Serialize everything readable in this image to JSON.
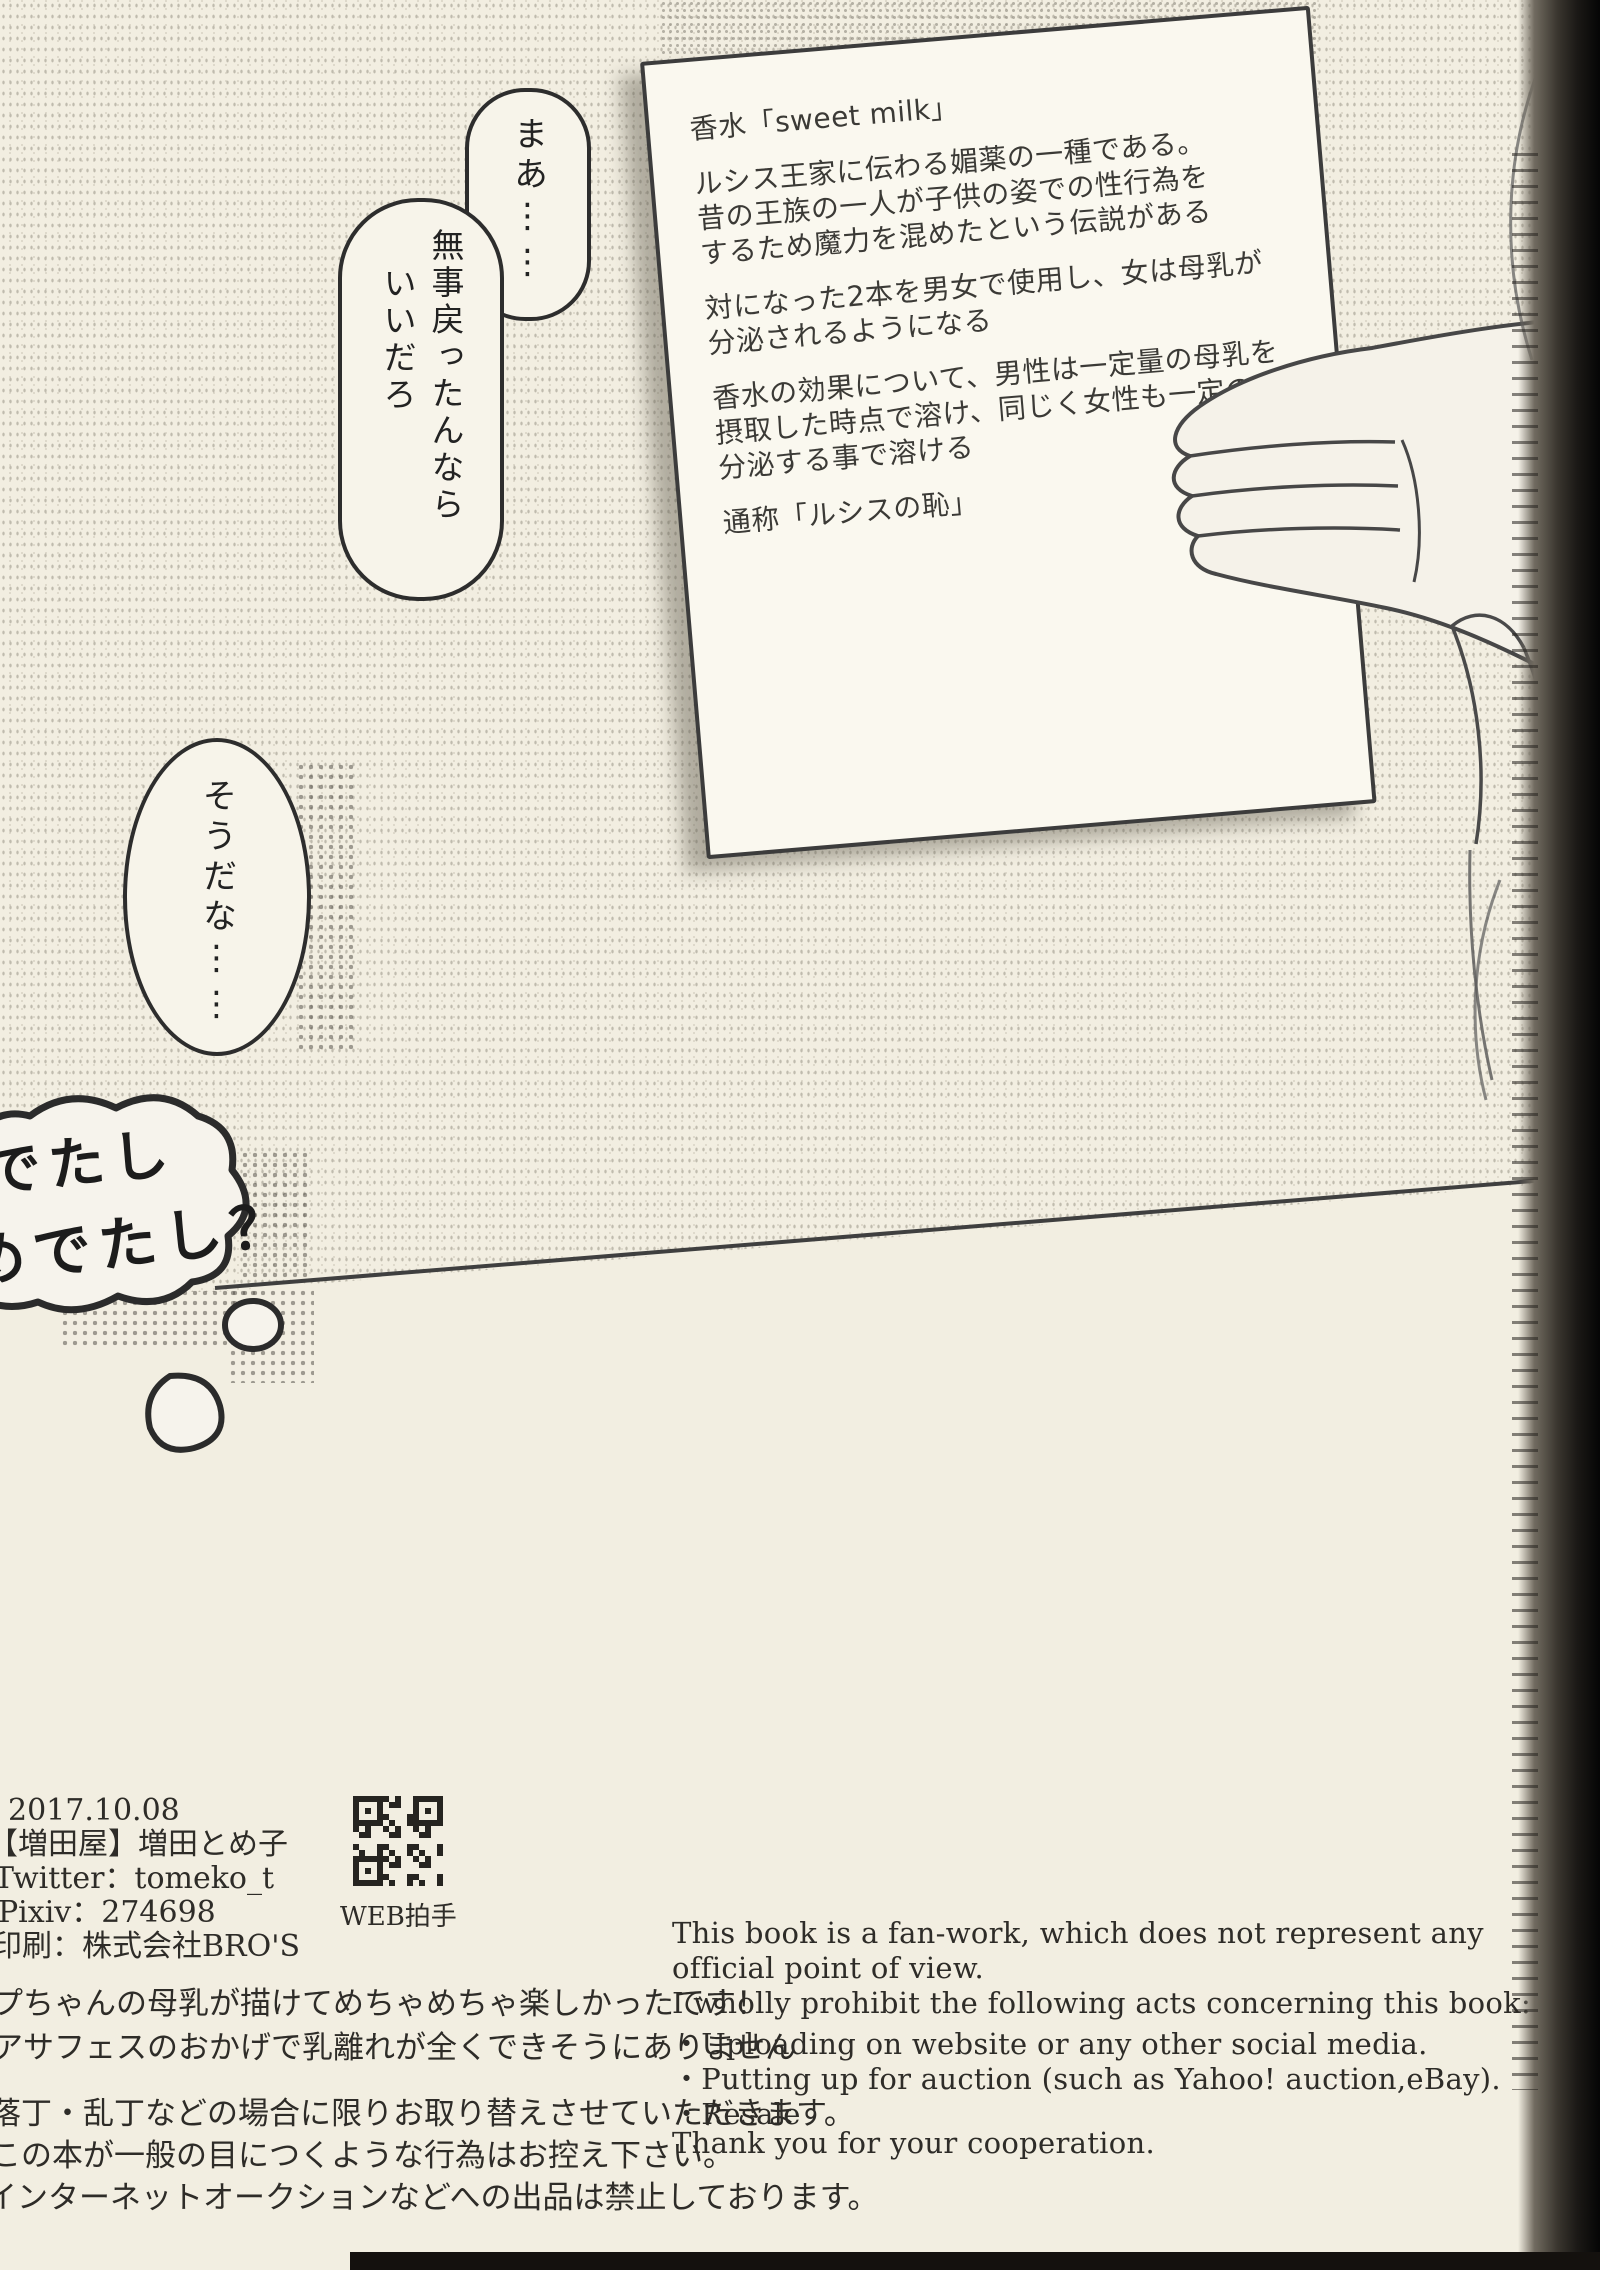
{
  "panel": {
    "bubbles": {
      "maa": "まあ⋮⋮",
      "buji_col1": "無事戻ったんなら",
      "buji_col2": "いいだろ",
      "souda": "そうだな⋮⋮",
      "cloud_line1": "でたし",
      "cloud_line2": "めでたし？"
    },
    "paper_note": {
      "lines": [
        "香水「sweet milk」",
        "",
        "ルシス王家に伝わる媚薬の一種である。",
        "昔の王族の一人が子供の姿での性行為を",
        "するため魔力を混めたという伝説がある",
        "",
        "対になった2本を男女で使用し、女は母乳が",
        "分泌されるようになる",
        "",
        "香水の効果について、男性は一定量の母乳を",
        "摂取した時点で溶け、同じく女性も一定の量を",
        "分泌する事で溶ける",
        "",
        "通称「ルシスの恥」"
      ]
    }
  },
  "colophon": {
    "date": "2017.10.08",
    "circle": "【増田屋】増田とめ子",
    "twitter": "Twitter：tomeko_t",
    "pixiv": "Pixiv：274698",
    "printer": "印刷：株式会社BRO'S",
    "qr_caption": "WEB拍手"
  },
  "afterword_jp": {
    "line1": "プちゃんの母乳が描けてめちゃめちゃ楽しかったです！",
    "line2": "アサフェスのおかげで乳離れが全くできそうにありません"
  },
  "notice_jp": {
    "line1": "落丁・乱丁などの場合に限りお取り替えさせていただきます。",
    "line2": "この本が一般の目につくような行為はお控え下さい。",
    "line3": "インターネットオークションなどへの出品は禁止しております。"
  },
  "notice_en": {
    "line1": "This book is a fan-work, which does not represent any",
    "line2": "official point of view.",
    "line3": "I wholly prohibit the following acts concerning this book:",
    "line4": "・Uploading on website or any other social media.",
    "line5": "・Putting up for auction (such as Yahoo! auction,eBay).",
    "line6": "・Resale",
    "line7": "Thank you for your cooperation."
  }
}
